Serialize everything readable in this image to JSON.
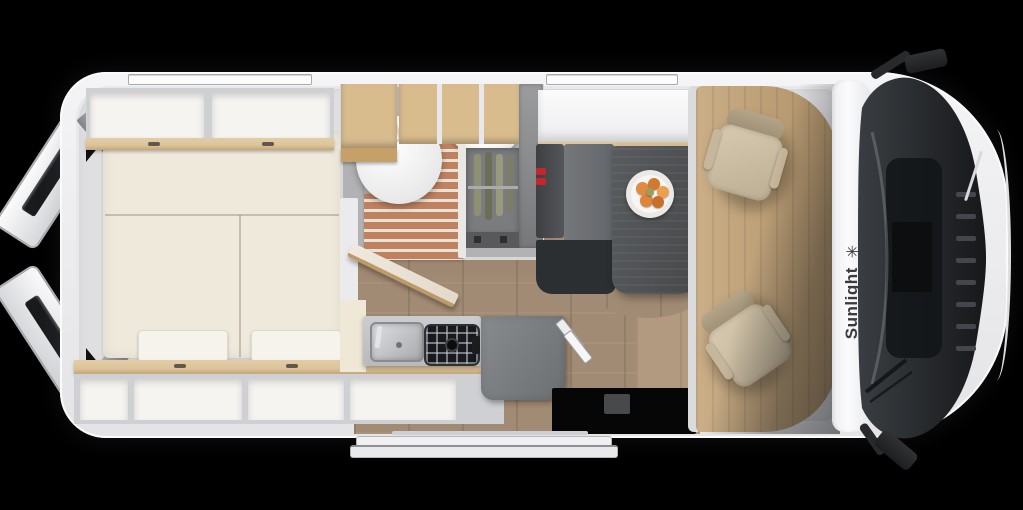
{
  "scene": {
    "title": "Sunlight camper van floor plan - top cutaway view",
    "background": "#000000"
  },
  "brand": {
    "name": "Sunlight",
    "logo_glyph": "✳"
  },
  "palette": {
    "background": "#000000",
    "wall": "#dfdfe2",
    "bed": "#efe9dc",
    "pillow": "#f6f3ec",
    "wood-trim": "#dcc49a",
    "wood-shelf": "#d8bc8e",
    "locker": "#f5f4f1",
    "bath-floor": "#b2b1b4",
    "slat": "#c08160",
    "slat-gap": "#e9e2d6",
    "toilet": "#fcfcfd",
    "wardrobe": "#7b7c7e",
    "bench-back": "#45474a",
    "bench-seat": "#6f7275",
    "bench-base": "#2c2f31",
    "table": "#4e5153",
    "plate": "#f7f6f3",
    "fruit": "#e18a42",
    "belt-red": "#c3272d",
    "floor": "#a28b74",
    "floor-light": "#b19a7f",
    "cab-floor": "#c2a173",
    "seat": "#cfc0a5",
    "windshield": "#26292c",
    "hood": "#f4f4f6",
    "entry": "#060607",
    "text-dark": "#3b3b3d"
  }
}
